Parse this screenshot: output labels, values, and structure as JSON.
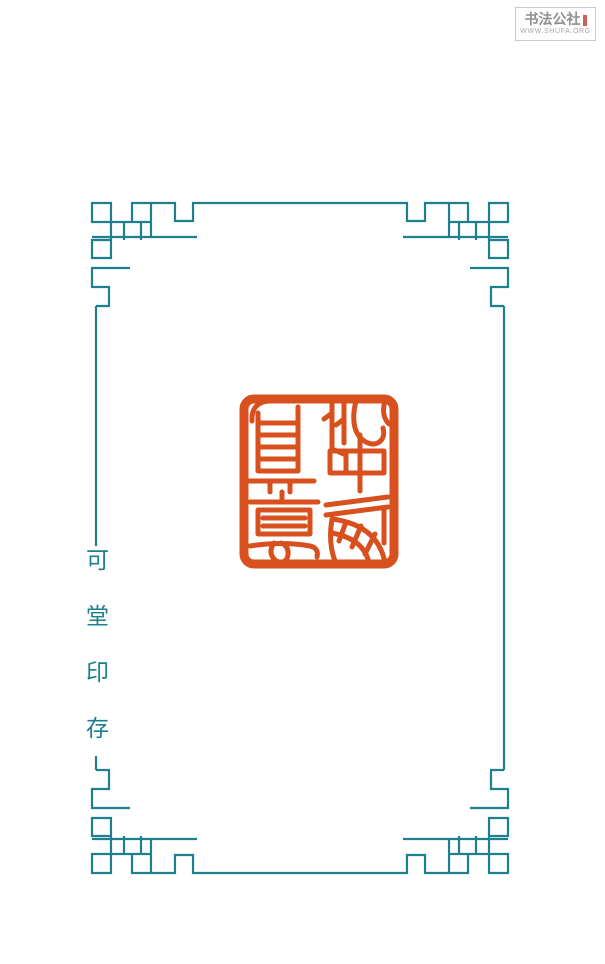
{
  "page": {
    "background_color": "#ffffff",
    "width_px": 605,
    "height_px": 964
  },
  "watermark": {
    "site_name": "书法公社",
    "site_url": "WWW.SHUFA.ORG",
    "text_color": "#8f8f8f",
    "url_color": "#a9a9a9",
    "border_color": "#cbcbcb",
    "seal_mark_color": "#c0392b"
  },
  "frame": {
    "color": "#1e7f8e",
    "style": "fret-corner lattice border"
  },
  "title": {
    "text": "可堂印存",
    "chars": [
      "可",
      "堂",
      "印",
      "存"
    ],
    "color": "#1e7f8e"
  },
  "seal": {
    "reading": "此中有真意",
    "color": "#d7501e",
    "shape": "square seal impression, seal-script carving"
  }
}
